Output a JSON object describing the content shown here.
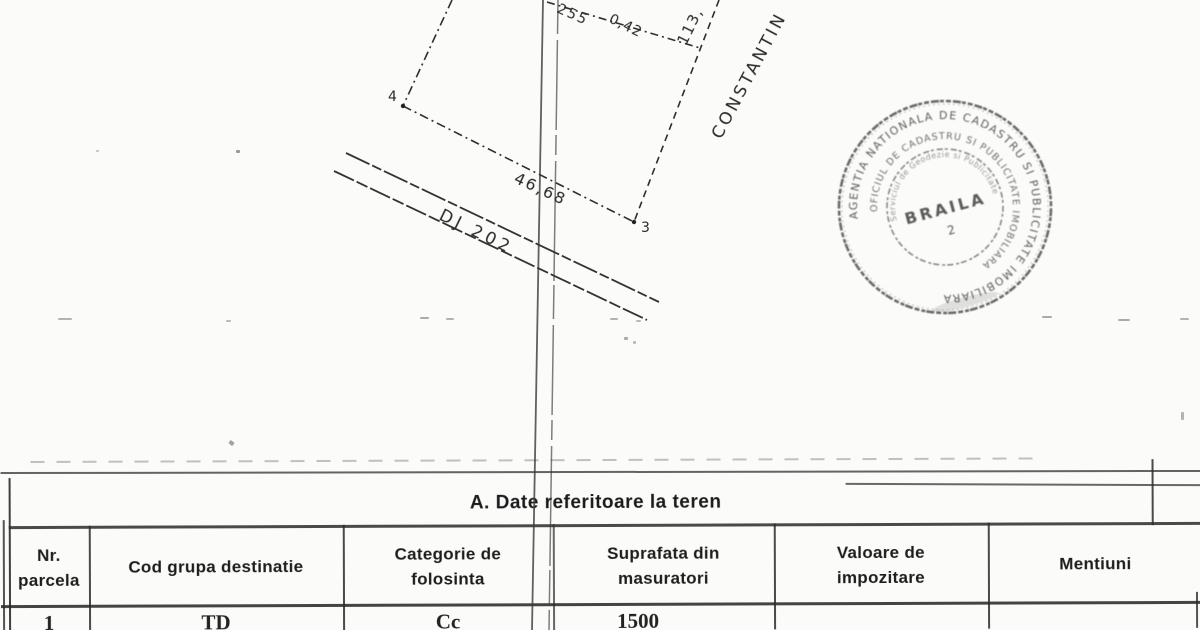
{
  "colors": {
    "paper": "#fbfbfa",
    "ink": "#222222",
    "stamp_ink": "#3f3f3f"
  },
  "plan": {
    "point_labels": {
      "p4": "4",
      "p3": "3"
    },
    "labels": {
      "top_dim_a": "255",
      "top_dim_b": "0,42",
      "right_dim": "113,",
      "bottom_dim": "46,68",
      "road": "DJ 202",
      "street": "CONSTANTIN"
    }
  },
  "stamp": {
    "outer_text": "AGENTIA NATIONALA DE CADASTRU SI PUBLICITATE IMOBILIARA",
    "middle_text": "OFICIUL DE CADASTRU SI PUBLICITATE IMOBILIARA",
    "inner_text": "Serviciul de Geodezie si Publicitate",
    "center_name": "BRAILA",
    "center_number": "2"
  },
  "table": {
    "title": "A. Date referitoare la teren",
    "headers": [
      {
        "line1": "Nr.",
        "line2": "parcela"
      },
      {
        "line1": "Cod grupa destinatie",
        "line2": ""
      },
      {
        "line1": "Categorie de",
        "line2": "folosinta"
      },
      {
        "line1": "Suprafata din",
        "line2": "masuratori"
      },
      {
        "line1": "Valoare de",
        "line2": "impozitare"
      },
      {
        "line1": "Mentiuni",
        "line2": ""
      }
    ],
    "row": [
      "1",
      "TD",
      "Cc",
      "1500",
      "",
      ""
    ]
  }
}
